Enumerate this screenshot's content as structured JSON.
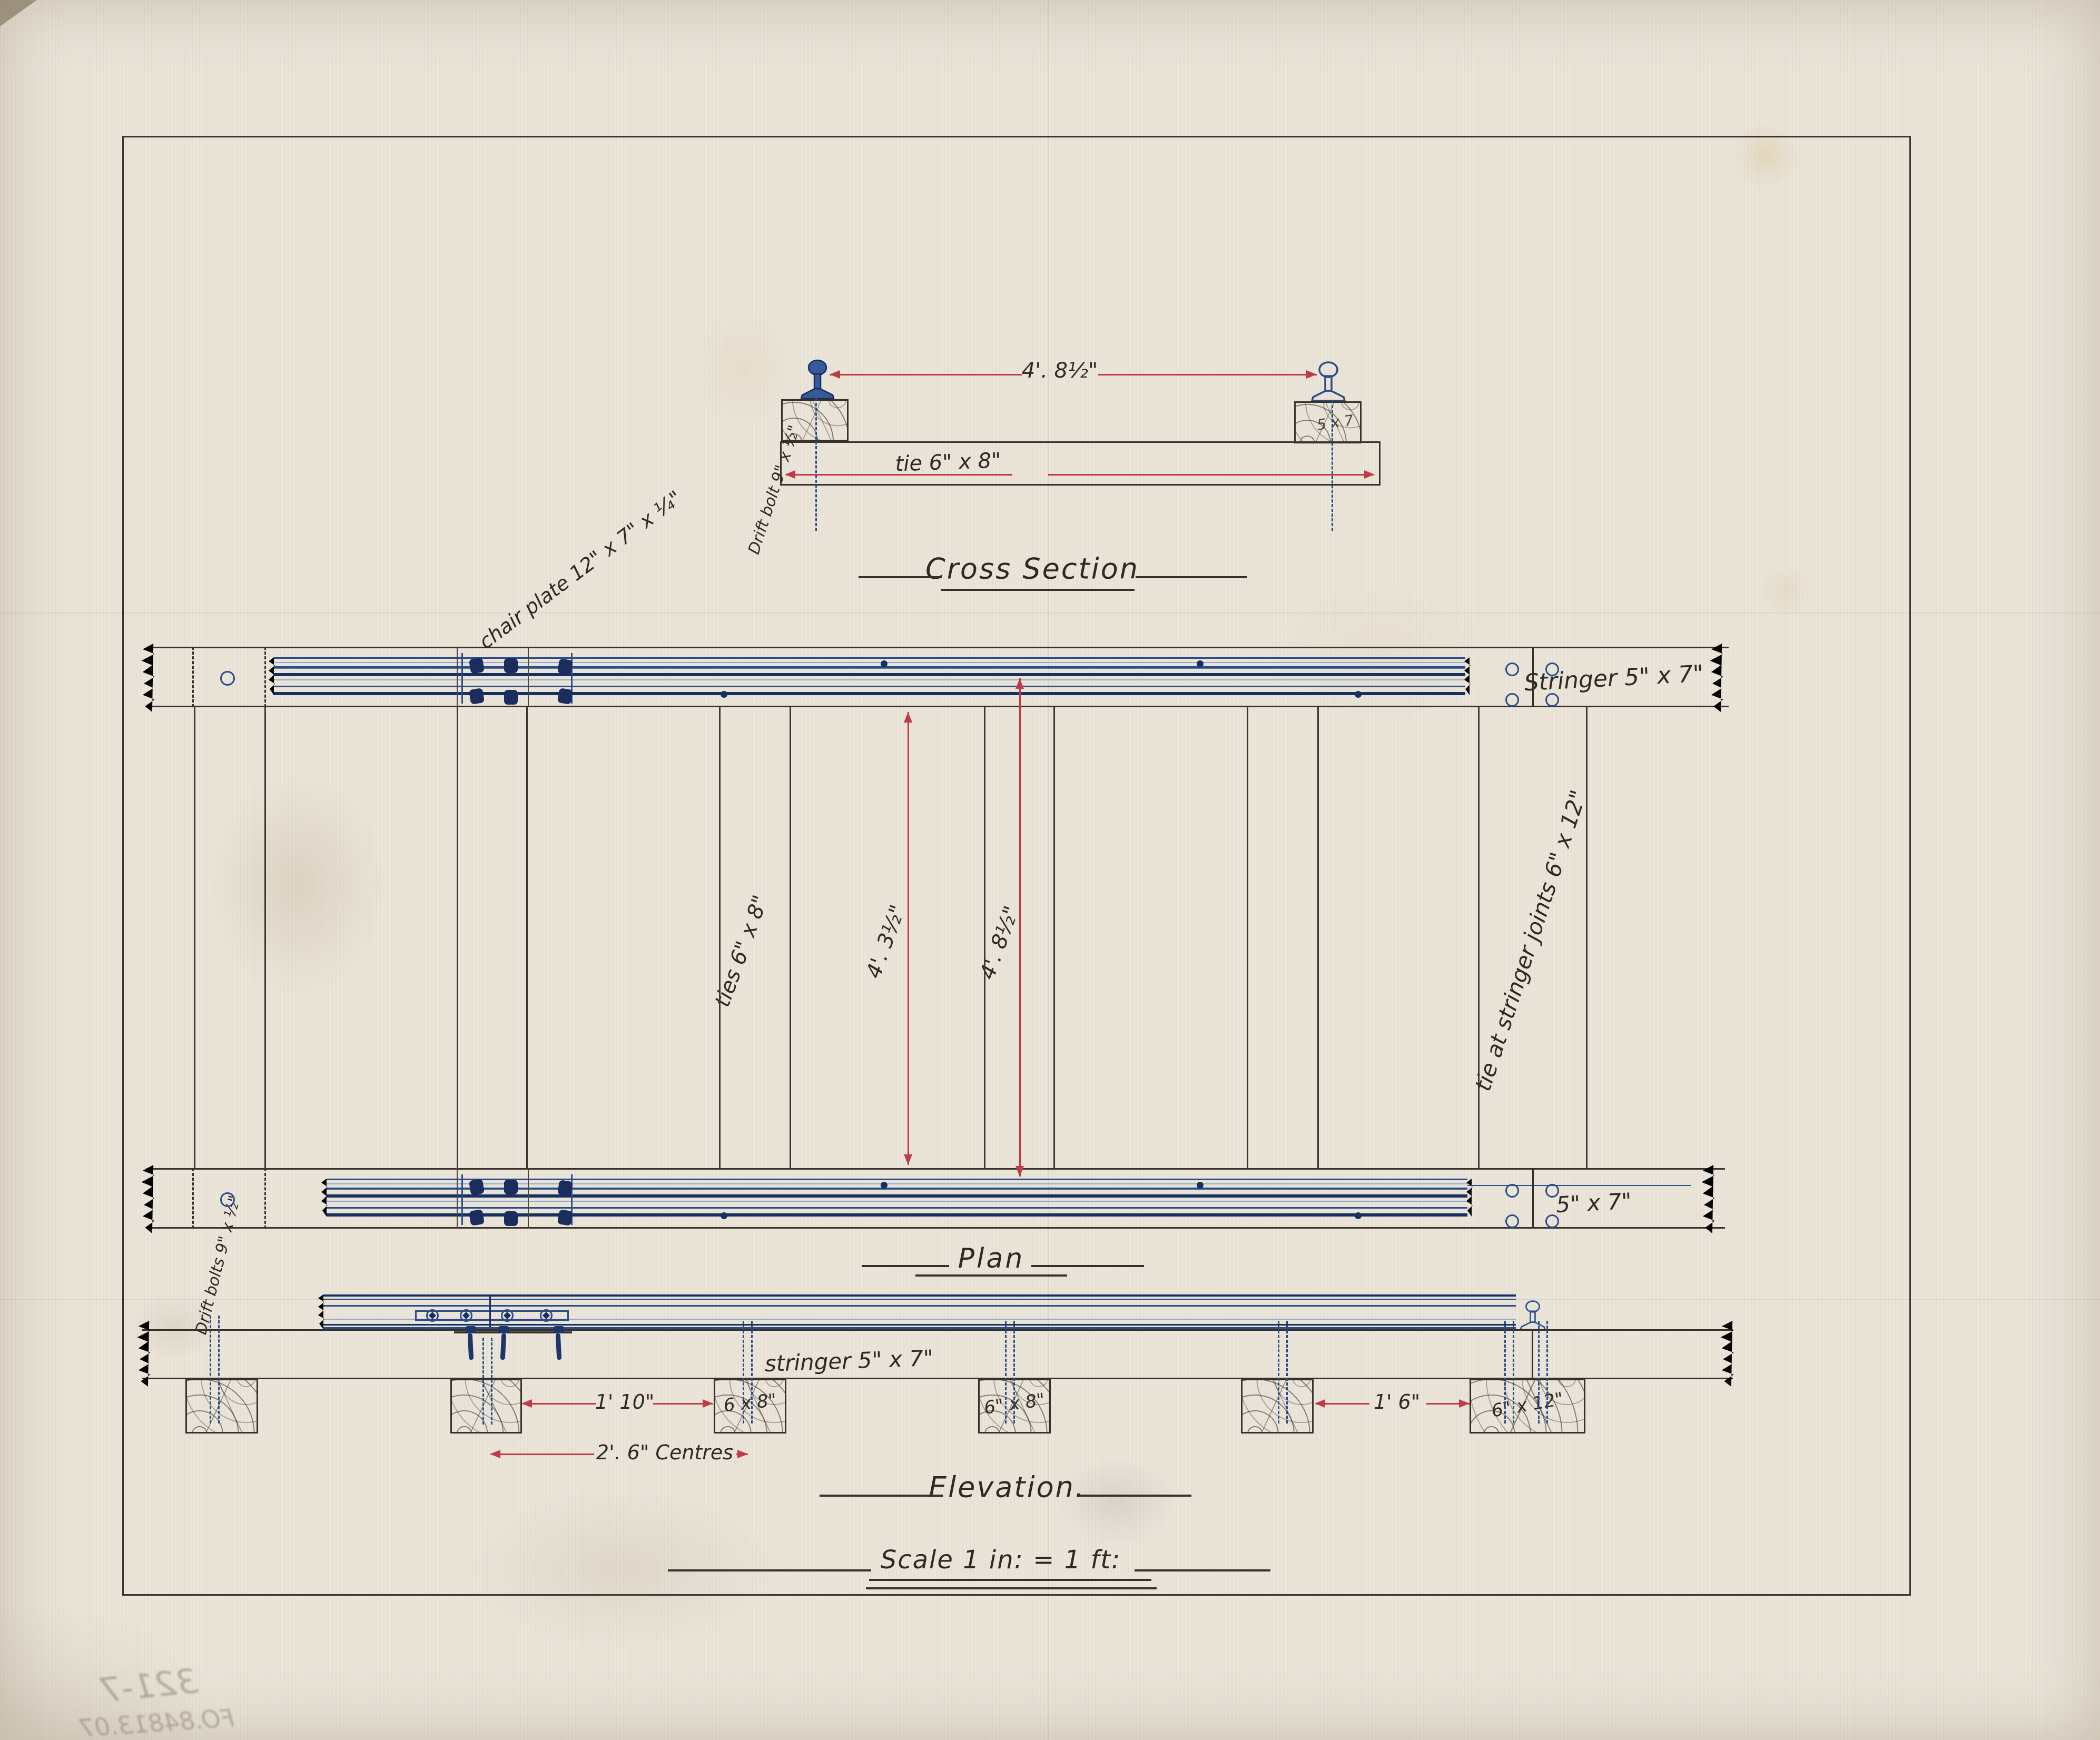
{
  "cross_section": {
    "title": "Cross Section",
    "gauge_dim": "4'. 8½\"",
    "tie_label": "tie 6\" x 8\"",
    "drift_bolt_label": "Drift bolt 9\" x ½\"",
    "right_block_label": "5 x 7"
  },
  "plan": {
    "title": "Plan",
    "chair_plate_label": "chair plate 12\" x 7\" x ¼\"",
    "stringer_top_label": "Stringer 5\" x 7\"",
    "stringer_bottom_label": "5\" x 7\"",
    "ties_label": "ties 6\" x 8\"",
    "dim_inner": "4'. 3½\"",
    "dim_gauge": "4'. 8½\"",
    "tie_joint_label": "tie at stringer joints 6\" x 12\""
  },
  "elevation": {
    "title": "Elevation.",
    "scale_label": "Scale 1 in: = 1 ft:",
    "stringer_label": "stringer 5\" x 7\"",
    "drift_bolts_label": "Drift bolts 9\" x ½\"",
    "dim_gap": "1' 10\"",
    "dim_centres": "2'. 6\" Centres",
    "dim_joint": "1' 6\"",
    "block_68a": "6 x 8\"",
    "block_68b": "6\" x 8\"",
    "block_612": "6\" x 12\""
  },
  "ghost": {
    "line1": "321-7",
    "line2": "FO.84813.07"
  },
  "colors": {
    "ink": "#332d26",
    "blue": "#2a4c88",
    "navy": "#1b2c5e",
    "red": "#c13b47",
    "paper": "#eae4d9"
  }
}
